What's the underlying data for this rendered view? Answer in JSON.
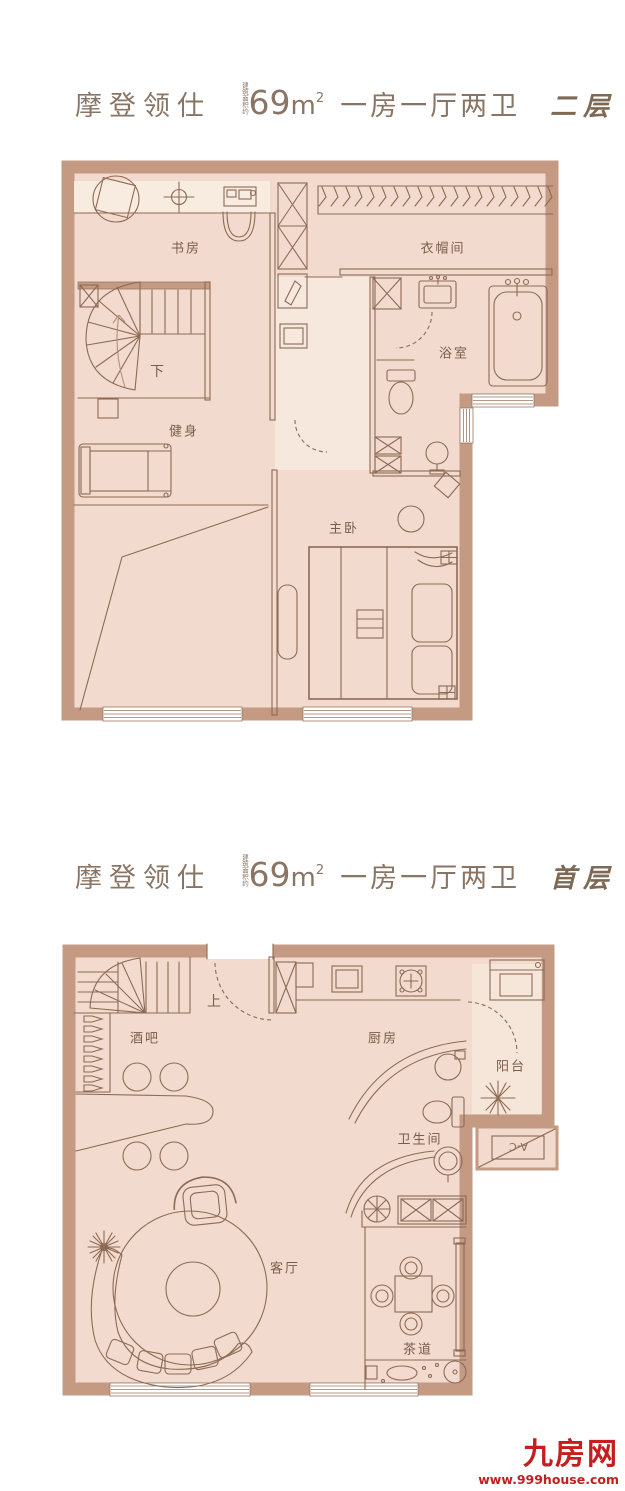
{
  "meta": {
    "colors": {
      "wall": "#c49a83",
      "floor": "#f2dbce",
      "line": "#8d6a54",
      "label": "#7a5d49",
      "title": "#8a7463",
      "watermark_red": "#c41e1e"
    }
  },
  "plans": [
    {
      "id": "second-floor",
      "title": {
        "project": "摩登领仕",
        "area_prefix": "建筑面积约",
        "area_value": "69",
        "area_unit": "m",
        "area_exp": "2",
        "layout": "一房一厅两卫",
        "floor_tag": "二层"
      },
      "rooms": [
        {
          "key": "study",
          "label": "书房"
        },
        {
          "key": "cloakroom",
          "label": "衣帽间"
        },
        {
          "key": "bathroom",
          "label": "浴室"
        },
        {
          "key": "gym",
          "label": "健身"
        },
        {
          "key": "master-bedroom",
          "label": "主卧"
        },
        {
          "key": "stair-down",
          "label": "下"
        }
      ]
    },
    {
      "id": "first-floor",
      "title": {
        "project": "摩登领仕",
        "area_prefix": "建筑面积约",
        "area_value": "69",
        "area_unit": "m",
        "area_exp": "2",
        "layout": "一房一厅两卫",
        "floor_tag": "首层"
      },
      "rooms": [
        {
          "key": "bar",
          "label": "酒吧"
        },
        {
          "key": "kitchen",
          "label": "厨房"
        },
        {
          "key": "balcony",
          "label": "阳台"
        },
        {
          "key": "wc",
          "label": "卫生间"
        },
        {
          "key": "living-room",
          "label": "客厅"
        },
        {
          "key": "tea-room",
          "label": "茶道"
        },
        {
          "key": "stair-up",
          "label": "上"
        }
      ]
    }
  ],
  "ac_label": "A-C",
  "watermark": {
    "brand": "九房网",
    "url": "www.999house.com"
  }
}
